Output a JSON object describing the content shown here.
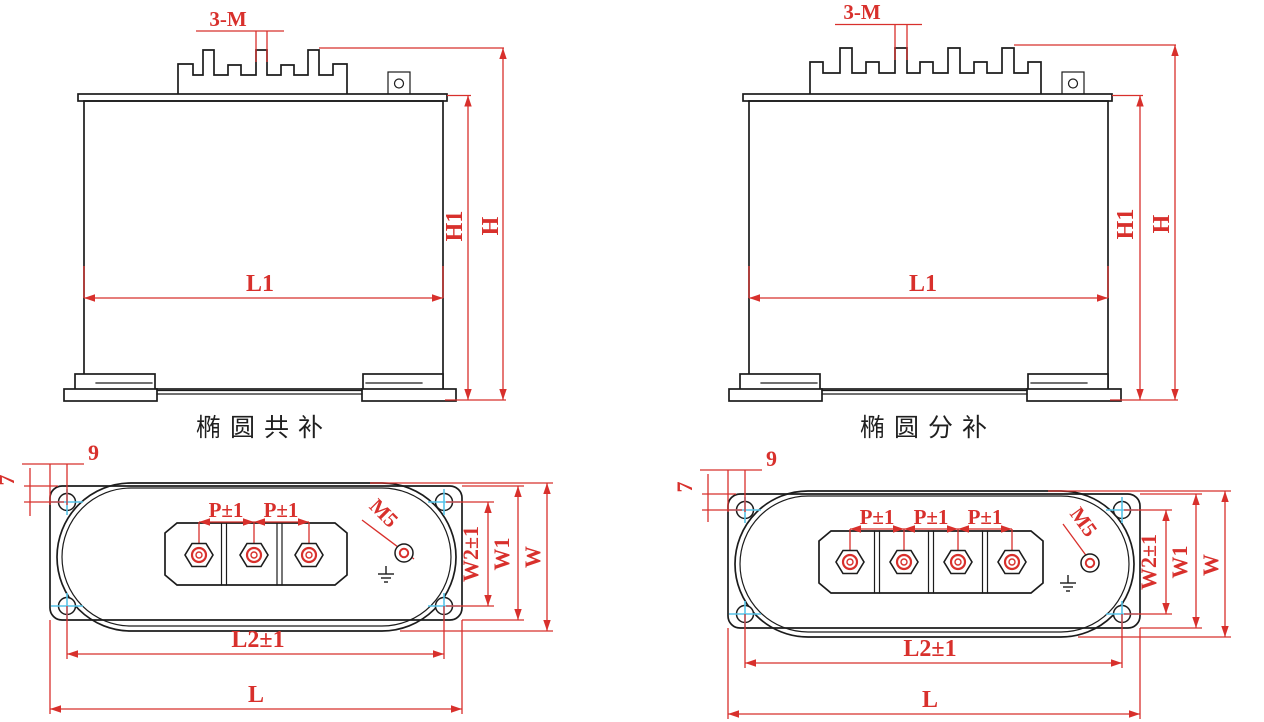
{
  "colors": {
    "outline": "#1c1c1c",
    "dimension_red": "#d8302c",
    "centerline_cyan": "#56c3e8",
    "background": "#ffffff"
  },
  "front_common": {
    "caption": "椭圆共补",
    "dim_studs": "3-M",
    "dim_height_inner": "H1",
    "dim_height_total": "H",
    "dim_length_body": "L1"
  },
  "front_split": {
    "caption": "椭圆分补",
    "dim_studs": "3-M",
    "dim_height_inner": "H1",
    "dim_height_total": "H",
    "dim_length_body": "L1"
  },
  "top_common": {
    "dim_hole_offset_h": "9",
    "dim_hole_offset_v": "7",
    "dim_pitch": [
      "P±1",
      "P±1"
    ],
    "dim_ground_thread": "M5",
    "dim_width_holes": "W2±1",
    "dim_width_flange": "W1",
    "dim_width_total": "W",
    "dim_length_holes": "L2±1",
    "dim_length_total": "L"
  },
  "top_split": {
    "dim_hole_offset_h": "9",
    "dim_hole_offset_v": "7",
    "dim_pitch": [
      "P±1",
      "P±1",
      "P±1"
    ],
    "dim_ground_thread": "M5",
    "dim_width_holes": "W2±1",
    "dim_width_flange": "W1",
    "dim_width_total": "W",
    "dim_length_holes": "L2±1",
    "dim_length_total": "L"
  }
}
